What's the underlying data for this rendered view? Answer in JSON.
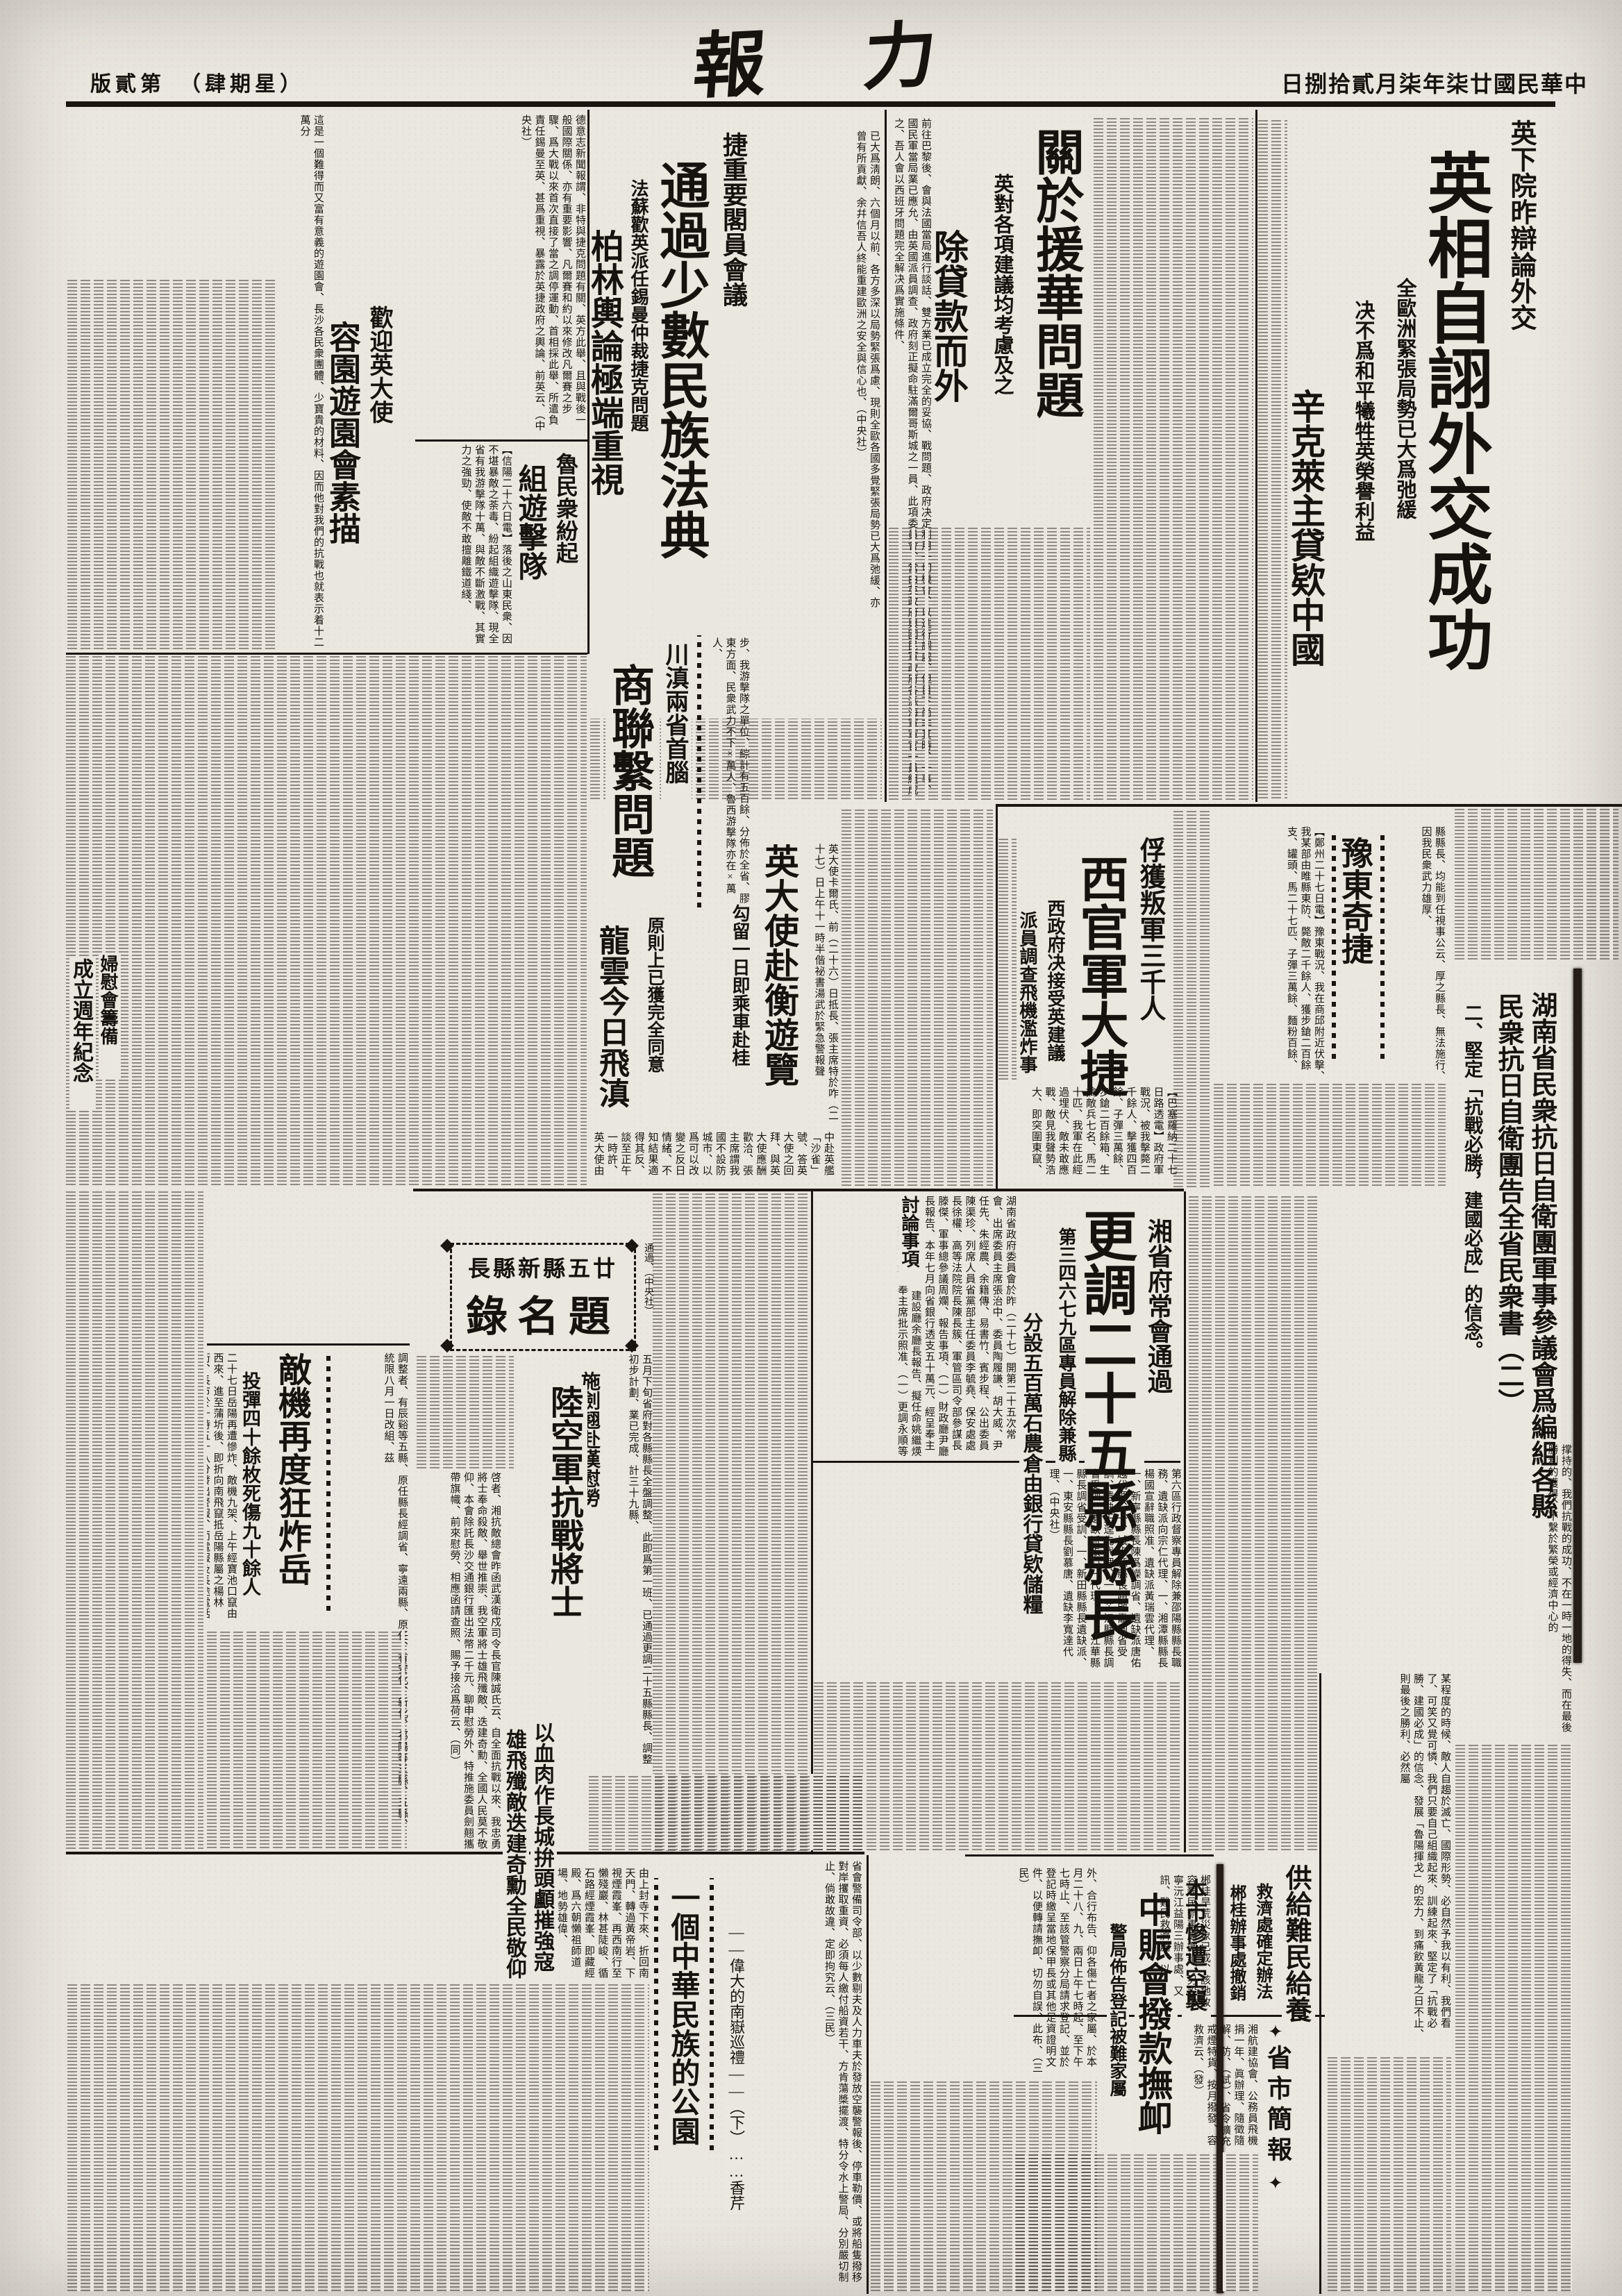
{
  "page": {
    "edition": "版貳第　（肆期星）",
    "date": "日捌拾貳月柒年柒廿國民華中",
    "masthead": "報　力"
  },
  "a": {
    "uk": {
      "kicker": "英下院昨辯論外交",
      "headline": "英相自詡外交成功",
      "sub1": "全歐洲緊張局勢已大爲弛緩",
      "sub2": "决不爲和平犧牲英榮譽利益",
      "sub3": "辛克萊主貸欵中國",
      "tail": "已大爲淸朗、六個月以前、各方多深以局勢緊張爲慮、現則全歐各國多覺緊張局勢已大爲弛緩、亦曾有所貢獻、余幷信吾人終能重建歐洲之安全與信心也、（中央社）"
    },
    "aid": {
      "headline": "關於援華問題",
      "sub1": "英對各項建議均考慮及之",
      "sub2": "除貸款而外",
      "body": "前往巴黎後、會與法國當局進行談話、雙方業已成立完全的妥協、戰問題、政府决定利用一切機會、以進行調處、但目下尚非其時、一事、國民軍當局業已應允、由英國派員調查、政府刻正擬命駐滿爾哥斯城之一員、此項委員會、當由英政府與國民軍政府各派海軍軍官一員組成之、吾人會以西班牙問題完全解决爲實施條件、"
    },
    "cz": {
      "kicker": "捷重要閣員會議",
      "headline1": "通過少數民族法典",
      "sub": "法蘇歡英派任錫曼仲裁捷克問題",
      "headline2": "柏林輿論極端重視",
      "body": "德意志新聞報謂、非特與捷克問題有關、英方此舉、且與戰後一般國際關係、亦有重要影響、凡爾賽和約以來修改凡爾賽之步驟、爲大戰以來首次直接了當之調停運動、首相採此舉、所遣負責任錫曼至英、甚爲重視、暴露於英捷政府之輿論、前英云、（中央社）"
    },
    "garden": {
      "kicker": "歡迎英大使",
      "headline": "容園遊園會素描",
      "body": "這是一個難得而又富有意義的遊園會、長沙各民衆團體、少寶貴的材料、因而他對我們的抗戰也就表示着十二萬分"
    },
    "shandong": {
      "kicker": "魯民衆紛起",
      "headline": "組遊擊隊",
      "body": "【信陽二十六日電】落後之山東民衆、因不堪暴敵之荼毒、紛起組織遊擊隊、現全省有我游擊隊十萬、與敵不斷激戰、其實力之強勁、使敵不敢擅離鐵道綫、"
    },
    "cd": {
      "kicker": "川滇兩省首腦",
      "headline": "商聯繫問題",
      "sub1": "原則上已獲完全同意",
      "sub2": "龍雲今日飛滇",
      "side": "步、我游擊隊之單位、綜計有五百餘、分佈於全省、膠東方面、民衆武力不下×萬人、魯西游擊隊亦在×萬人、"
    },
    "amb": {
      "headline": "英大使赴衡遊覽",
      "sub": "勾留一日即乘車赴桂",
      "lead": "英大使卡爾氏、前（二十六）日抵長、張主席特於咋（二十七）日上午十一時半偕祕書湯武於緊急警報聲",
      "body": "中赴英艦「沙雀」號、答英大使之回拜、與英大使應酬歡洽、張主席謂我國不設防城市、以爲可以改變之反日情緒、不知結果適得其反、談至正午一時許、英大使由湖南大學參觀被炸遺蹟、大使對湖大圖書館之被燬、甚爲惋惜、"
    },
    "xg": {
      "kicker": "俘獲叛軍三千人",
      "headline": "西官軍大捷",
      "sub1": "西政府决接受英建議",
      "sub2": "派員調查飛機濫炸事",
      "body": "【巴塞羅納二十七日路透電】政府軍戰況、被我擊斃二千餘人、擊獲四百餘、子彈三萬餘、步鎗二百餘箱、生擒敵兵七名、馬二十匹、我軍在此經過埋伏、敵未敢應戰、敵見我聲勢浩大、即突圍東竄、"
    },
    "yd": {
      "headline": "豫東奇捷",
      "body": "【鄭州二十七日電】豫東戰況、我在商邱附近伏擊、我某部由睢縣東防、斃敵二千餘人、獲步鎗二百餘支、罐頭、馬二十七匹、子彈三萬餘、麵粉百餘、",
      "side": "縣縣長、均能到任視事公云、厚之縣長、無法施行、因我民衆武力雄厚、"
    },
    "letter": {
      "headline1": "湖南省民衆抗日自衛團軍事參議會爲編組各縣",
      "headline2": "民衆抗日自衛團告全省民衆書（二）",
      "section": "二、堅定「抗戰必勝，建國必成」的信念。",
      "body1": "撑持的、我們抗戰的成功、不在一時一地的得失、而在最後勝利的獲得、不繫於繁榮或經濟中心的",
      "body2": "某程度的時候、敵人自趨於滅亡、國際形勢、必自然予我以有利、我們看了、可笑又覺可憐、我們只要自己組織起來、訓練起來、堅定了「抗戰必勝、建國必成」的信念、發展「魯陽揮戈」的宏力、到痛飲黃龍之日不止、則最後之勝利、必然屬"
    },
    "xs": {
      "kicker": "湘省府常會通過",
      "headline": "更調二十五縣縣長",
      "sub1": "第三四六七九區專員解除兼縣長職",
      "sub2": "分設五百萬石農倉由銀行貸欵儲糧",
      "discuss": "討論事項",
      "body": "湖南省政府委員會於昨（二十七）開第二十五次常會、出席委員主席張治中、委員陶履謙、胡大威、尹任先、朱經農、余籍傳、易書竹、賓步程、公出委員陳渠珍、列席人員省黨部主任委員李毓堯、保安處處長徐權、高等法院院長陳長簇、軍管區司令部參謀長滕傑、軍事總參議周斕、報告事項、（一）財政廳尹廳長報告、本年七月向省銀行透支五十萬元、經呈奉主席批示照辦、（二）建設廳余廳長報告、擬任命姚繼煐爲本廳技正、經呈奉主席批示照准、（一）更調永順等二十五縣縣長、又第三第四第六第七第九各區行政督察專員、均解除兼縣長職務、經呈奉主席核准、提前令派、",
      "list": "第六區行政督察專員解除兼邵陽縣縣長職務、遺缺派向宗仁代理、一、湘潭縣縣長楊國宣辭職照准、遺缺派黃瑞雲代理、一、新寧縣縣長陳爲嶸調省、遺缺派唐佑越代理、一、城步縣縣長趙啟霱調省受訓、遺缺王逵先代理、一、芷江縣縣長調省受訓、遺缺派張心一代理、一、江華縣縣長調省受訓、一、新田縣縣長遺缺派、一、東安縣縣長劉慕唐、遺缺李寬達代理、（中央社）"
    },
    "tm": {
      "title_top": "長縣新縣五廿",
      "title_main": "錄名題",
      "note": "通過、（中央社）",
      "body": "五月下旬省府對各縣縣長全盤調整、此即爲第一班、已通過更調二十五縣縣長、調整初步計劃、業已完成、計三十九縣、"
    },
    "yy": {
      "headline": "敵機再度狂炸岳陽",
      "sub": "投彈四十餘枚死傷九十餘人",
      "body": "二十七日岳陽再遭慘炸、敵機九架、上午經寶池口竄由西來、進至蒲圻後、即折向南飛竄抵岳陽縣屬之楊林街、長市於十時五十八分發出警報、而電報及長途電話",
      "side": "調整者、有辰谿等五縣、原任縣長經調省、寧遠兩縣、原任、有安化、新化、祁陽等三縣、五縣、統限八月一日改組、茲"
    },
    "sjq": {
      "kicker": "施劍翹赴漢慰勞",
      "headline": "陸空軍抗戰將士",
      "slogan1": "以血肉作長城拚頭顱摧強寇",
      "slogan2": "雄飛殲敵迭建奇勳全民敬仰",
      "body": "啓者、湘抗敵總會昨函武漢衛戍司令長官陳誠氏云、自全面抗戰以來、我忠勇將士奉命殺敵、舉世推崇、我空軍將士雄飛殲敵、迭建奇勳、全國人民莫不敬仰、本會除託長沙交通銀行匯出法幣二千元、聊申慰勞外、特推施委員劍翹攜帶旗幟、前來慰勞、相應函請查照、賜予接洽爲荷云、（同）"
    },
    "ny": {
      "headline": "一個中華民族的公園",
      "subtitle": "——偉大的南嶽巡禮——（下）……香芹",
      "body": "由上封寺下來、折回南天門、轉過黃帝岩、下視煙霞峯、再西南行至懶殘巖、林甚陡峻、循石路經煙霞峯、即藏經殿、爲六朝懶祖師道場、地勢雄偉、"
    },
    "zh": {
      "kicker": "本市慘遭空襲",
      "headline": "中賑會撥款撫卹",
      "sub": "警局佈告登記被難家屬",
      "body": "外、合行布告、仰各傷亡者之家屬、於本月二十八、九、兩日上午七時起、至下午七時止、至該管警察分局請求登記、並於登記時繳呈當地保甲長或其他足資證明文件、以便轉請撫卹、切勿自誤、此布、（三民）",
      "body2": "省會警備司令部、以少數剔夫及人力車夫於發放空襲警報後、停車勒價、或將船隻撥移對岸攫取重資、必須每人繳付船資若干、方肯蕩槳擺渡、特分令水上警局、分別嚴切制止、倘敢故違、定即拘究云、（三民）"
    },
    "rf": {
      "headline": "供給難民給養",
      "sub1": "救濟處確定辦法",
      "sub2": "郴桂辦事處撤銷",
      "body": "郴桂旱荒災象已成、該地收容難民辦事處撤銷、另設常寧沅江益陽三辦事處、又訊、難民救濟處、以"
    },
    "br": {
      "title": "省市簡報",
      "body": "湘航建協會、公務員飛機捐一年、眞辦理、隨徵隨解、防、（試）、省令擴充戒煙特貨、按月撥發、容救濟云、（發）"
    },
    "fn": {
      "kicker": "婦慰會籌備",
      "headline": "成立週年紀念"
    }
  }
}
